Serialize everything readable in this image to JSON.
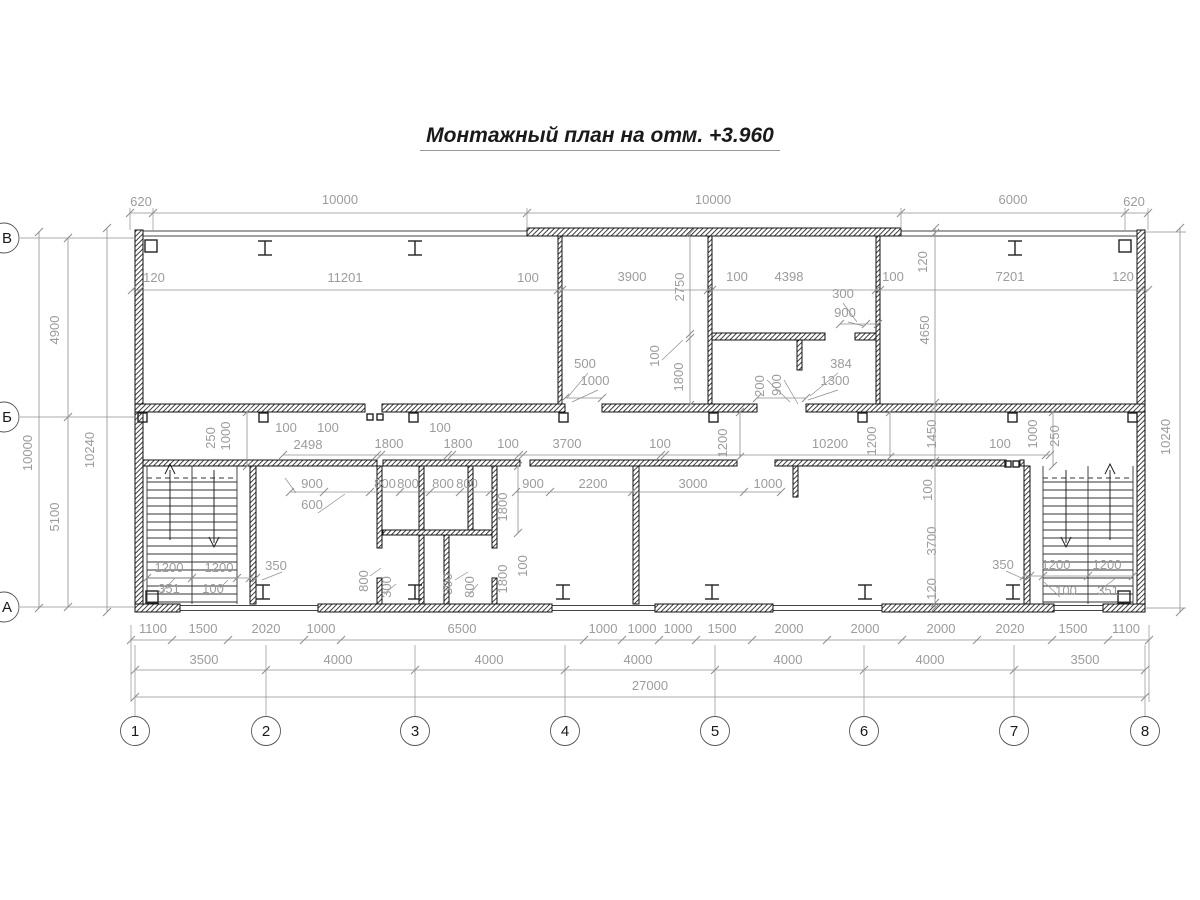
{
  "title": "Монтажный план на отм. +3.960",
  "axes": {
    "columns": [
      {
        "label": "1",
        "x": 135
      },
      {
        "label": "2",
        "x": 266
      },
      {
        "label": "3",
        "x": 415
      },
      {
        "label": "4",
        "x": 565
      },
      {
        "label": "5",
        "x": 715
      },
      {
        "label": "6",
        "x": 864
      },
      {
        "label": "7",
        "x": 1014
      },
      {
        "label": "8",
        "x": 1145
      }
    ],
    "rows": [
      {
        "label": "В",
        "y": 238
      },
      {
        "label": "Б",
        "y": 417
      },
      {
        "label": "А",
        "y": 607
      }
    ]
  },
  "colors": {
    "wall": "#2a2a2a",
    "dim_text": "#9c9c9c",
    "dim_line": "#8f8f8f",
    "thin_line": "#444444",
    "axis_text": "#1a1a1a"
  },
  "dimensions": [
    {
      "t": "620",
      "x": 141,
      "y": 206,
      "v": false
    },
    {
      "t": "10000",
      "x": 340,
      "y": 204,
      "v": false
    },
    {
      "t": "10000",
      "x": 713,
      "y": 204,
      "v": false
    },
    {
      "t": "6000",
      "x": 1013,
      "y": 204,
      "v": false
    },
    {
      "t": "620",
      "x": 1134,
      "y": 206,
      "v": false
    },
    {
      "t": "120",
      "x": 154,
      "y": 282,
      "v": false
    },
    {
      "t": "11201",
      "x": 345,
      "y": 282,
      "v": false
    },
    {
      "t": "100",
      "x": 528,
      "y": 282,
      "v": false
    },
    {
      "t": "3900",
      "x": 632,
      "y": 281,
      "v": false
    },
    {
      "t": "100",
      "x": 737,
      "y": 281,
      "v": false
    },
    {
      "t": "4398",
      "x": 789,
      "y": 281,
      "v": false
    },
    {
      "t": "100",
      "x": 893,
      "y": 281,
      "v": false
    },
    {
      "t": "7201",
      "x": 1010,
      "y": 281,
      "v": false
    },
    {
      "t": "120",
      "x": 1123,
      "y": 281,
      "v": false
    },
    {
      "t": "2750",
      "x": 684,
      "y": 287,
      "v": true
    },
    {
      "t": "120",
      "x": 927,
      "y": 262,
      "v": true
    },
    {
      "t": "4650",
      "x": 929,
      "y": 330,
      "v": true
    },
    {
      "t": "100",
      "x": 659,
      "y": 356,
      "v": true
    },
    {
      "t": "1800",
      "x": 683,
      "y": 377,
      "v": true
    },
    {
      "t": "200",
      "x": 764,
      "y": 386,
      "v": true
    },
    {
      "t": "900",
      "x": 781,
      "y": 385,
      "v": true
    },
    {
      "t": "300",
      "x": 843,
      "y": 298,
      "v": false
    },
    {
      "t": "900",
      "x": 845,
      "y": 317,
      "v": false
    },
    {
      "t": "500",
      "x": 585,
      "y": 368,
      "v": false
    },
    {
      "t": "1000",
      "x": 595,
      "y": 385,
      "v": false
    },
    {
      "t": "384",
      "x": 841,
      "y": 368,
      "v": false
    },
    {
      "t": "1300",
      "x": 835,
      "y": 385,
      "v": false
    },
    {
      "t": "4900",
      "x": 59,
      "y": 330,
      "v": true
    },
    {
      "t": "10000",
      "x": 32,
      "y": 453,
      "v": true
    },
    {
      "t": "10240",
      "x": 94,
      "y": 450,
      "v": true
    },
    {
      "t": "5100",
      "x": 59,
      "y": 517,
      "v": true
    },
    {
      "t": "10240",
      "x": 1170,
      "y": 437,
      "v": true
    },
    {
      "t": "250",
      "x": 215,
      "y": 438,
      "v": true
    },
    {
      "t": "1000",
      "x": 230,
      "y": 436,
      "v": true
    },
    {
      "t": "100",
      "x": 286,
      "y": 432,
      "v": false
    },
    {
      "t": "100",
      "x": 328,
      "y": 432,
      "v": false
    },
    {
      "t": "2498",
      "x": 308,
      "y": 449,
      "v": false
    },
    {
      "t": "1800",
      "x": 389,
      "y": 448,
      "v": false
    },
    {
      "t": "100",
      "x": 440,
      "y": 432,
      "v": false
    },
    {
      "t": "1800",
      "x": 458,
      "y": 448,
      "v": false
    },
    {
      "t": "100",
      "x": 508,
      "y": 448,
      "v": false
    },
    {
      "t": "3700",
      "x": 567,
      "y": 448,
      "v": false
    },
    {
      "t": "100",
      "x": 660,
      "y": 448,
      "v": false
    },
    {
      "t": "1200",
      "x": 727,
      "y": 443,
      "v": true
    },
    {
      "t": "10200",
      "x": 830,
      "y": 448,
      "v": false
    },
    {
      "t": "1200",
      "x": 876,
      "y": 441,
      "v": true
    },
    {
      "t": "1450",
      "x": 936,
      "y": 434,
      "v": true
    },
    {
      "t": "100",
      "x": 1000,
      "y": 448,
      "v": false
    },
    {
      "t": "1000",
      "x": 1037,
      "y": 434,
      "v": true
    },
    {
      "t": "250",
      "x": 1059,
      "y": 436,
      "v": true
    },
    {
      "t": "900",
      "x": 312,
      "y": 488,
      "v": false
    },
    {
      "t": "600",
      "x": 312,
      "y": 509,
      "v": false
    },
    {
      "t": "800",
      "x": 385,
      "y": 488,
      "v": false
    },
    {
      "t": "800",
      "x": 408,
      "y": 488,
      "v": false
    },
    {
      "t": "800",
      "x": 443,
      "y": 488,
      "v": false
    },
    {
      "t": "800",
      "x": 467,
      "y": 488,
      "v": false
    },
    {
      "t": "900",
      "x": 533,
      "y": 488,
      "v": false
    },
    {
      "t": "2200",
      "x": 593,
      "y": 488,
      "v": false
    },
    {
      "t": "3000",
      "x": 693,
      "y": 488,
      "v": false
    },
    {
      "t": "1000",
      "x": 768,
      "y": 488,
      "v": false
    },
    {
      "t": "1800",
      "x": 507,
      "y": 507,
      "v": true
    },
    {
      "t": "100",
      "x": 932,
      "y": 490,
      "v": true
    },
    {
      "t": "3700",
      "x": 936,
      "y": 541,
      "v": true
    },
    {
      "t": "120",
      "x": 936,
      "y": 589,
      "v": true
    },
    {
      "t": "1200",
      "x": 169,
      "y": 572,
      "v": false
    },
    {
      "t": "1200",
      "x": 219,
      "y": 572,
      "v": false
    },
    {
      "t": "350",
      "x": 276,
      "y": 570,
      "v": false
    },
    {
      "t": "351",
      "x": 169,
      "y": 593,
      "v": false
    },
    {
      "t": "100",
      "x": 213,
      "y": 593,
      "v": false
    },
    {
      "t": "800",
      "x": 368,
      "y": 581,
      "v": true
    },
    {
      "t": "300",
      "x": 391,
      "y": 587,
      "v": true
    },
    {
      "t": "300",
      "x": 452,
      "y": 584,
      "v": true
    },
    {
      "t": "800",
      "x": 474,
      "y": 587,
      "v": true
    },
    {
      "t": "1800",
      "x": 507,
      "y": 579,
      "v": true
    },
    {
      "t": "100",
      "x": 527,
      "y": 566,
      "v": true
    },
    {
      "t": "350",
      "x": 1003,
      "y": 569,
      "v": false
    },
    {
      "t": "1200",
      "x": 1056,
      "y": 569,
      "v": false
    },
    {
      "t": "1200",
      "x": 1107,
      "y": 569,
      "v": false
    },
    {
      "t": "100",
      "x": 1066,
      "y": 595,
      "v": false
    },
    {
      "t": "351",
      "x": 1108,
      "y": 595,
      "v": false
    },
    {
      "t": "1100",
      "x": 153,
      "y": 633,
      "v": false
    },
    {
      "t": "1500",
      "x": 203,
      "y": 633,
      "v": false
    },
    {
      "t": "2020",
      "x": 266,
      "y": 633,
      "v": false
    },
    {
      "t": "1000",
      "x": 321,
      "y": 633,
      "v": false
    },
    {
      "t": "6500",
      "x": 462,
      "y": 633,
      "v": false
    },
    {
      "t": "1000",
      "x": 603,
      "y": 633,
      "v": false
    },
    {
      "t": "1000",
      "x": 642,
      "y": 633,
      "v": false
    },
    {
      "t": "1000",
      "x": 678,
      "y": 633,
      "v": false
    },
    {
      "t": "1500",
      "x": 722,
      "y": 633,
      "v": false
    },
    {
      "t": "2000",
      "x": 789,
      "y": 633,
      "v": false
    },
    {
      "t": "2000",
      "x": 865,
      "y": 633,
      "v": false
    },
    {
      "t": "2000",
      "x": 941,
      "y": 633,
      "v": false
    },
    {
      "t": "2020",
      "x": 1010,
      "y": 633,
      "v": false
    },
    {
      "t": "1500",
      "x": 1073,
      "y": 633,
      "v": false
    },
    {
      "t": "1100",
      "x": 1126,
      "y": 633,
      "v": false
    },
    {
      "t": "3500",
      "x": 204,
      "y": 664,
      "v": false
    },
    {
      "t": "4000",
      "x": 338,
      "y": 664,
      "v": false
    },
    {
      "t": "4000",
      "x": 489,
      "y": 664,
      "v": false
    },
    {
      "t": "4000",
      "x": 638,
      "y": 664,
      "v": false
    },
    {
      "t": "4000",
      "x": 788,
      "y": 664,
      "v": false
    },
    {
      "t": "4000",
      "x": 930,
      "y": 664,
      "v": false
    },
    {
      "t": "3500",
      "x": 1085,
      "y": 664,
      "v": false
    },
    {
      "t": "27000",
      "x": 650,
      "y": 690,
      "v": false
    }
  ]
}
